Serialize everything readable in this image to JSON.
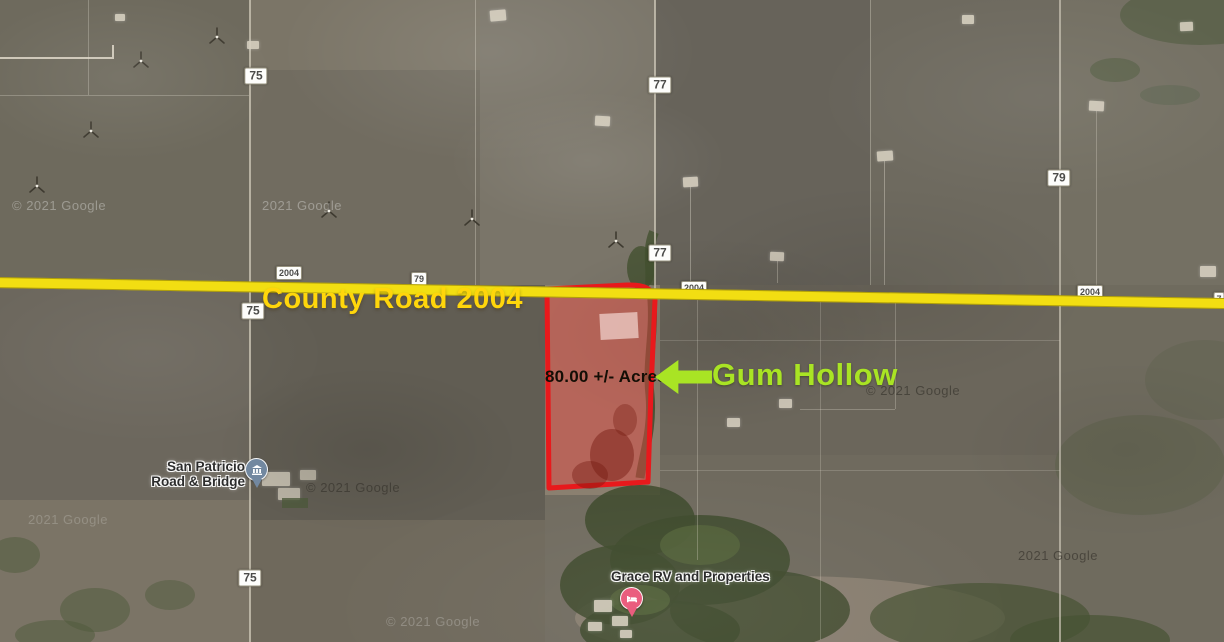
{
  "annotations": {
    "road_title": "County Road 2004",
    "parcel_acres": "80.00 +/- Acres",
    "callout_label": "Gum Hollow"
  },
  "road_shields": [
    "75",
    "77",
    "79",
    "77",
    "2004",
    "79",
    "75",
    "2004",
    "2004",
    "75",
    "7"
  ],
  "pois": {
    "san_patricio": {
      "line1": "San Patricio",
      "line2": "Road & Bridge",
      "icon": "government-building-pin"
    },
    "grace_rv": {
      "label": "Grace RV and Properties",
      "icon": "lodging-bed-pin"
    }
  },
  "watermarks": [
    "© 2021 Google",
    "2021 Google",
    "© 2021 Google",
    "© 2021 Google",
    "2021 Google",
    "© 2021 Google",
    "2021 Google"
  ],
  "colors": {
    "county_road_line": "#F2DE12",
    "county_road_text": "#FFD60B",
    "parcel_outline": "#E8191C",
    "parcel_fill": "rgba(235,70,65,0.45)",
    "callout_green": "#A9E424",
    "government_pin": "#7288A0",
    "lodging_pin": "#EA5D7E"
  }
}
